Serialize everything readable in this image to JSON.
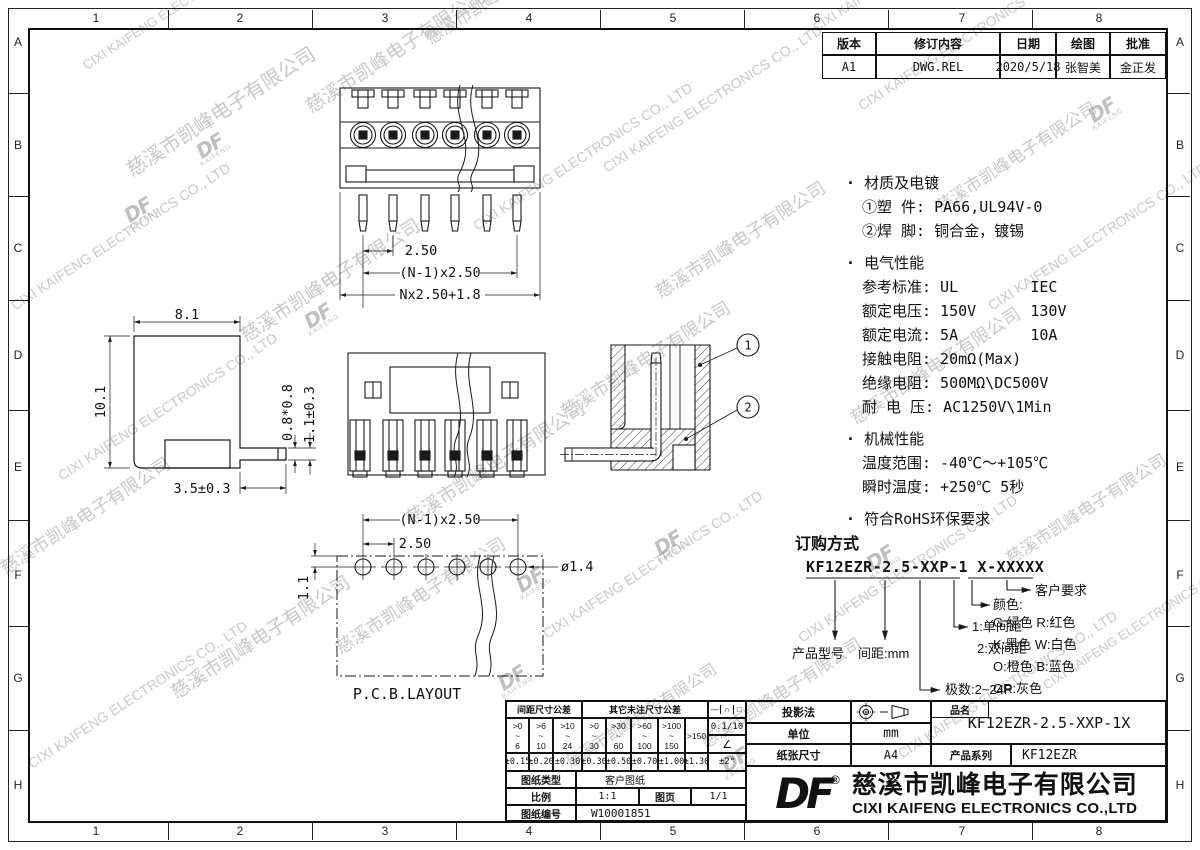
{
  "sheet": {
    "bg": "#ffffff",
    "line": "#1a1a1a",
    "watermark_color": "#c9c9c9"
  },
  "grid": {
    "cols": [
      "1",
      "2",
      "3",
      "4",
      "5",
      "6",
      "7",
      "8"
    ],
    "rows": [
      "A",
      "B",
      "C",
      "D",
      "E",
      "F",
      "G",
      "H"
    ]
  },
  "revision_table": {
    "headers": [
      "版本",
      "修订内容",
      "日期",
      "绘图",
      "批准"
    ],
    "row": [
      "A1",
      "DWG.REL",
      "2020/5/18",
      "张智美",
      "金正发"
    ]
  },
  "watermark": {
    "cn": "慈溪市凯峰电子有限公司",
    "en": "CIXI KAIFENG ELECTRONICS CO., LTD",
    "logo": "DF",
    "logo_sub": "KAIFENG"
  },
  "specs": {
    "sections": [
      {
        "title": "材质及电镀",
        "lines": [
          "①塑 件: PA66,UL94V-0",
          "②焊 脚: 铜合金，镀锡"
        ]
      },
      {
        "title": "电气性能",
        "lines": [
          "参考标准: UL        IEC",
          "额定电压: 150V      130V",
          "额定电流: 5A        10A",
          "接触电阻: 20mΩ(Max)",
          "绝缘电阻: 500MΩ\\DC500V",
          "耐 电 压: AC1250V\\1Min"
        ]
      },
      {
        "title": "机械性能",
        "lines": [
          "温度范围: -40℃～+105℃",
          "瞬时温度: +250℃ 5秒"
        ]
      },
      {
        "title": "符合RoHS环保要求",
        "lines": []
      }
    ]
  },
  "ordering": {
    "title": "订购方式",
    "code": "KF12EZR-2.5-XXP-1 X-XXXXX",
    "product_model": "产品型号",
    "pitch": "间距:mm",
    "poles": "极数:2~24P",
    "row1": "1:单间距",
    "row2": "2:双间距",
    "color_title": "颜色:",
    "colors": [
      "G:绿色  R:红色",
      "K:黑色  W:白色",
      "O:橙色  B:蓝色",
      "GR:灰色"
    ],
    "customer": "客户要求"
  },
  "drawings": {
    "front_dims": [
      "2.50",
      "(N-1)x2.50",
      "Nx2.50+1.8"
    ],
    "side_dims": [
      "8.1",
      "10.1",
      "0.8*0.8",
      "1.1±0.3",
      "3.5±0.3"
    ],
    "pcb_dims": [
      "(N-1)x2.50",
      "2.50",
      "1.1",
      "ø1.4"
    ],
    "pcb_label": "P.C.B.LAYOUT",
    "balloons": [
      "1",
      "2"
    ]
  },
  "title_block": {
    "tol": {
      "header_pitch": "间距尺寸公差",
      "header_other": "其它未注尺寸公差",
      "symbols": [
        "—",
        "∩",
        "□"
      ],
      "flatness": "0.1/10",
      "angle_symbol": "∠",
      "angle_tol": "±2°",
      "range_sep": "~",
      "ranges": [
        {
          "top": ">0",
          "bot": "6"
        },
        {
          "top": ">6",
          "bot": "10"
        },
        {
          "top": ">10",
          "bot": "24"
        },
        {
          "top": ">0",
          "bot": "30"
        },
        {
          "top": ">30",
          "bot": "60"
        },
        {
          "top": ">60",
          "bot": "100"
        },
        {
          "top": ">100",
          "bot": "150"
        },
        {
          "top": ">150",
          "bot": ""
        }
      ],
      "values": [
        "±0.15",
        "±0.20",
        "±0.30",
        "±0.30",
        "±0.50",
        "±0.70",
        "±1.00",
        "±1.30"
      ]
    },
    "sheet_type_label": "图纸类型",
    "sheet_type_value": "客户图纸",
    "scale_label": "比例",
    "scale_value": "1:1",
    "page_label": "图页",
    "page_value": "1/1",
    "number_label": "图纸编号",
    "number_value": "W10001851",
    "projection_label": "投影法",
    "unit_label": "单位",
    "unit_value": "mm",
    "paper_label": "纸张尺寸",
    "paper_value": "A4",
    "name_label": "品名",
    "name_value": "KF12EZR-2.5-XXP-1X",
    "series_label": "产品系列",
    "series_value": "KF12EZR",
    "company": {
      "logo": "DF",
      "reg": "®",
      "cn": "慈溪市凯峰电子有限公司",
      "en": "CIXI KAIFENG ELECTRONICS CO.,LTD"
    }
  }
}
